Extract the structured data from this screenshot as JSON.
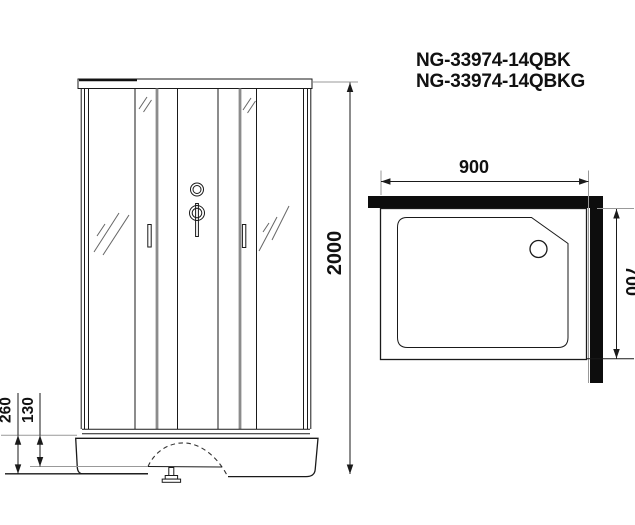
{
  "title": {
    "model_1": "NG-33974-14QBK",
    "model_2": "NG-33974-14QBKG"
  },
  "front_view": {
    "height_label": "2000",
    "base_height_label": "260",
    "base_step_label": "130"
  },
  "top_view": {
    "width_label": "900",
    "depth_label": "700"
  },
  "colors": {
    "line": "#1a1a1a",
    "wall_fill": "#0d0d0d",
    "extension_line": "#999999",
    "door_stile": "#8c8c8c",
    "background": "#ffffff"
  }
}
